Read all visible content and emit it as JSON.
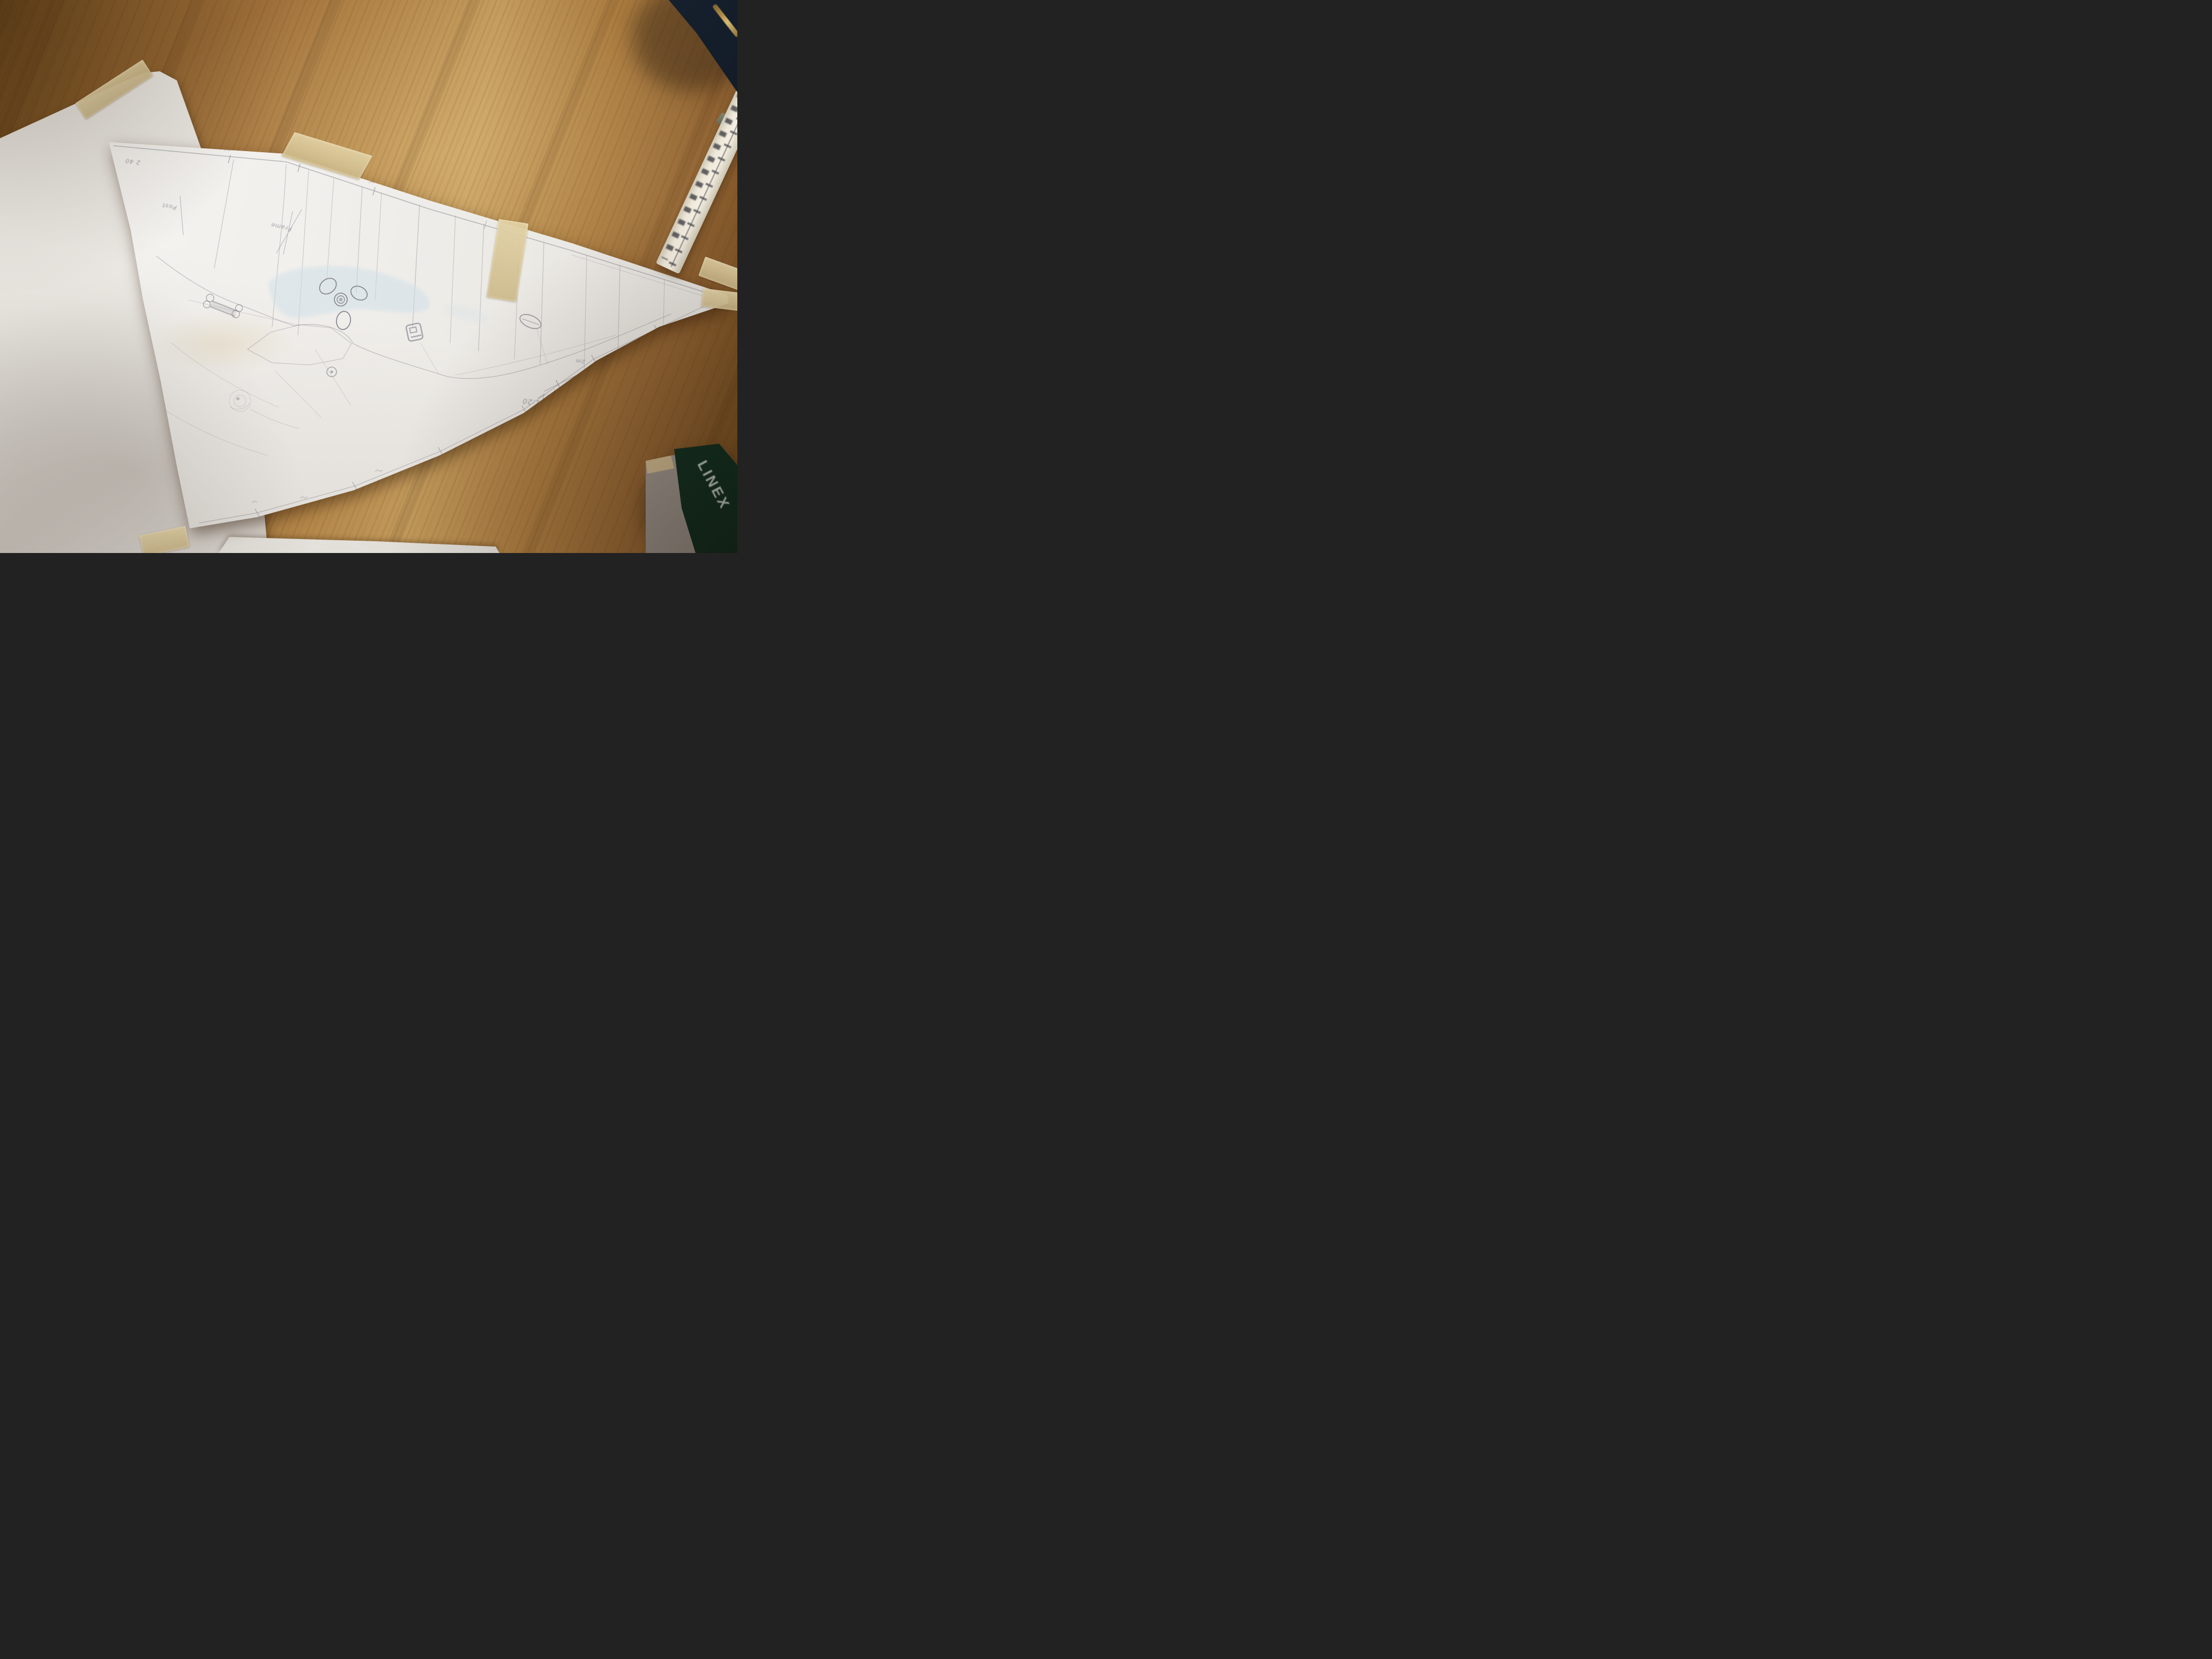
{
  "colors": {
    "wood_base": "#a0703a",
    "wood_light": "#c29a5c",
    "wood_dark": "#6e4a1e",
    "backing_paper": "#e9e6e1",
    "drawing_paper": "#f1efeb",
    "tape": "#d8c79c",
    "pencil": "#8b8a93",
    "blue_wash": "#cfdfe9",
    "navy_object": "#16202e",
    "zipper_gold": "#b6914a",
    "linex_green": "#17402f",
    "linex_text": "#cdd8d0",
    "gray_card": "#b3aca5",
    "ruler_body": "#efe9da"
  },
  "sketch": {
    "apex_note": "2 40",
    "labels": [
      {
        "id": "post",
        "text": "Post"
      },
      {
        "id": "frame",
        "text": "Frame"
      }
    ],
    "scale": {
      "ratio": "1:20",
      "length_label": "2m"
    }
  },
  "objects": {
    "linex_case": {
      "brand": "LINEX"
    }
  }
}
